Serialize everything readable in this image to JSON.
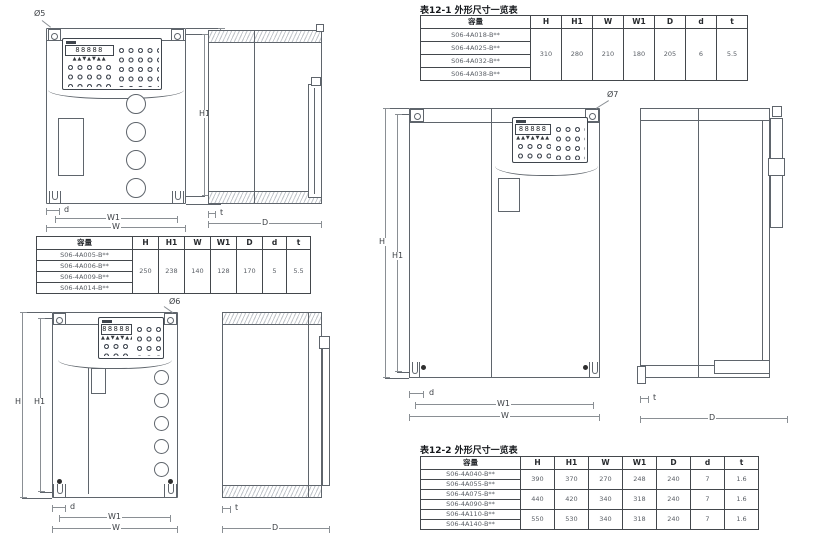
{
  "labels": {
    "h": "H",
    "h1": "H1",
    "w": "W",
    "w1": "W1",
    "d": "d",
    "t": "t",
    "depth": "D",
    "hole_small": "Ø5",
    "hole_medium": "Ø6",
    "hole_large": "Ø7"
  },
  "keypad": {
    "digits": "88888",
    "leds": "▲▲▼▲▼▲▲"
  },
  "tables": {
    "small": {
      "header": [
        "容量",
        "H",
        "H1",
        "W",
        "W1",
        "D",
        "d",
        "t"
      ],
      "models": [
        "S06-4A005-B**",
        "S06-4A006-B**",
        "S06-4A009-B**",
        "S06-4A014-B**"
      ],
      "values": [
        "250",
        "238",
        "140",
        "128",
        "170",
        "5",
        "5.5"
      ]
    },
    "t1": {
      "title": "表12-1  外形尺寸一览表",
      "header": [
        "容量",
        "H",
        "H1",
        "W",
        "W1",
        "D",
        "d",
        "t"
      ],
      "models": [
        "S06-4A018-B**",
        "S06-4A025-B**",
        "S06-4A032-B**",
        "S06-4A038-B**"
      ],
      "values": [
        "310",
        "280",
        "210",
        "180",
        "205",
        "6",
        "5.5"
      ]
    },
    "t2": {
      "title": "表12-2  外形尺寸一览表",
      "header": [
        "容量",
        "H",
        "H1",
        "W",
        "W1",
        "D",
        "d",
        "t"
      ],
      "groups": [
        {
          "models": [
            "S06-4A040-B**",
            "S06-4A055-B**"
          ],
          "values": [
            "390",
            "370",
            "270",
            "248",
            "240",
            "7",
            "1.6"
          ]
        },
        {
          "models": [
            "S06-4A075-B**",
            "S06-4A090-B**"
          ],
          "values": [
            "440",
            "420",
            "340",
            "318",
            "240",
            "7",
            "1.6"
          ]
        },
        {
          "models": [
            "S06-4A110-B**",
            "S06-4A140-B**"
          ],
          "values": [
            "550",
            "530",
            "340",
            "318",
            "240",
            "7",
            "1.6"
          ]
        }
      ]
    }
  }
}
